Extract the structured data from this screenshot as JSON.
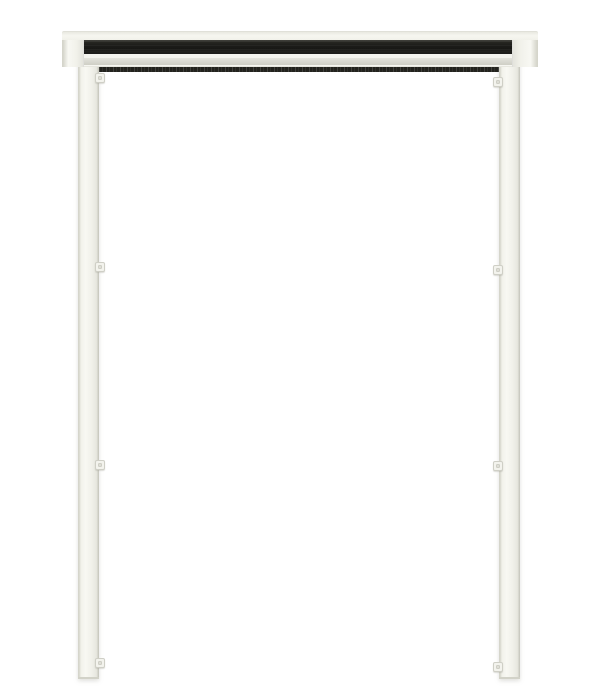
{
  "photo": {
    "description": "Studio product photo on a white background: a white metal door-opening frame kit made of two vertical side rails joined at the top by a head-rail cassette. The cassette has a recessed black slot channel and a light grey groove band, with a black brush seal running beneath it between the rails. Four small mounting clips protrude from the inner edge of each side rail. The frame is open at the bottom.",
    "background": "#ffffff"
  },
  "colors": {
    "background": "#ffffff",
    "frame_white": "#f1f1ea",
    "frame_bright": "#f8f8f3",
    "frame_edge": "#d5d5cb",
    "frame_shadow": "#c3c3b9",
    "cassette_black": "#1d1d1a",
    "black_highlight": "#45453f",
    "groove_grey": "#d8d8d0",
    "brush_dark": "#23231e",
    "brush_speckle": "#4a4a40",
    "clip_face": "#f3f3ed",
    "clip_edge": "#cfcfc6"
  },
  "parts": {
    "head_rail": "head rail cassette",
    "screen_slot": "screen slot channel",
    "brush_seal": "brush seal",
    "left_rail": "left side rail",
    "right_rail": "right side rail",
    "mounting_clip": "mounting clip",
    "clip_count": 8
  }
}
